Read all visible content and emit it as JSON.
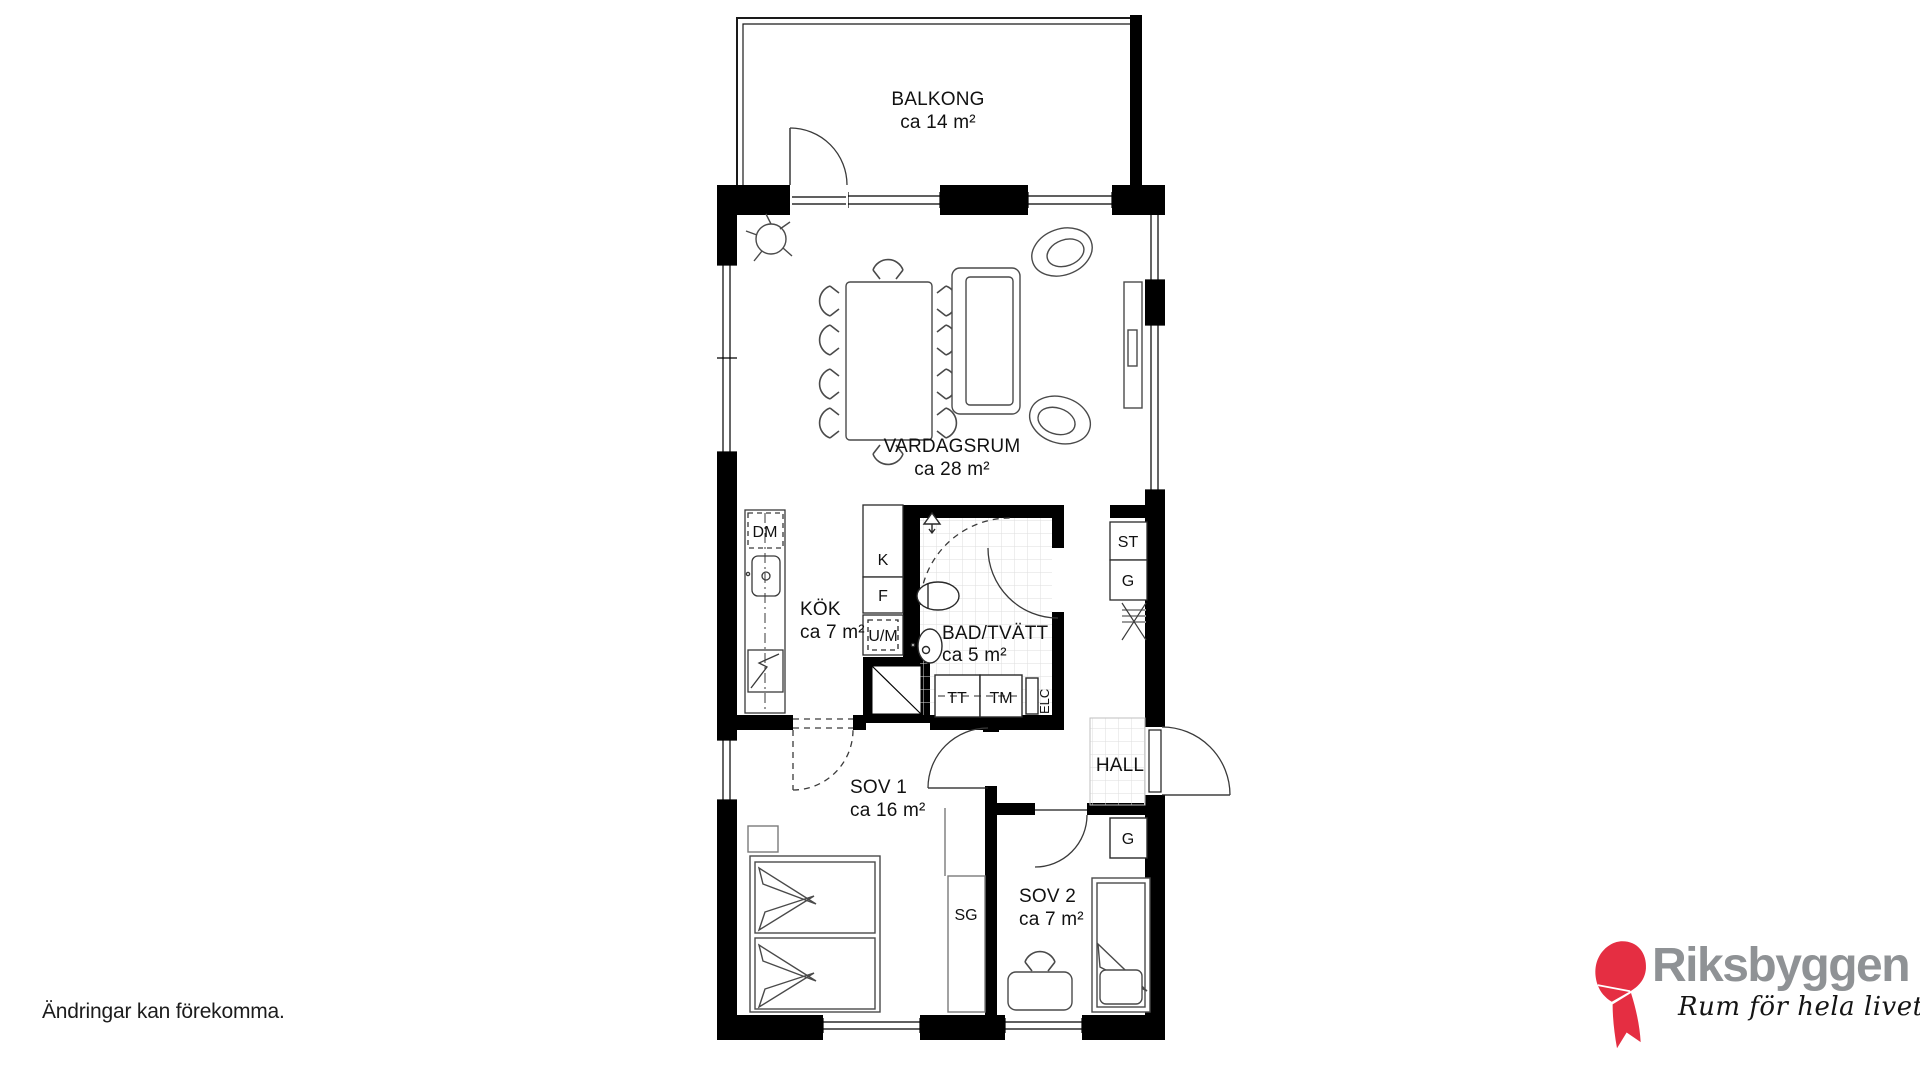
{
  "plan": {
    "rooms": {
      "balkong": {
        "name": "BALKONG",
        "area": "ca 14 m²"
      },
      "vardagsrum": {
        "name": "VARDAGSRUM",
        "area": "ca 28 m²"
      },
      "kok": {
        "name": "KÖK",
        "area": "ca 7 m²"
      },
      "bad_tvatt": {
        "name": "BAD/TVÄTT",
        "area": "ca 5 m²"
      },
      "sov1": {
        "name": "SOV 1",
        "area": "ca 16 m²"
      },
      "sov2": {
        "name": "SOV 2",
        "area": "ca 7 m²"
      },
      "hall": {
        "name": "HALL"
      }
    },
    "fixtures": {
      "dm": "DM",
      "k": "K",
      "f": "F",
      "um": "U/M",
      "tt": "TT",
      "tm": "TM",
      "elc": "ELC",
      "st": "ST",
      "g_hall": "G",
      "g_sov2": "G",
      "sg": "SG"
    },
    "wall_color": "#000000",
    "tile_color": "#dedede"
  },
  "footer": {
    "disclaimer": "Ändringar kan förekomma."
  },
  "logo": {
    "brand": "Riksbyggen",
    "tagline": "Rum för hela livet",
    "red": "#e52e42",
    "gray": "#8f9295"
  }
}
